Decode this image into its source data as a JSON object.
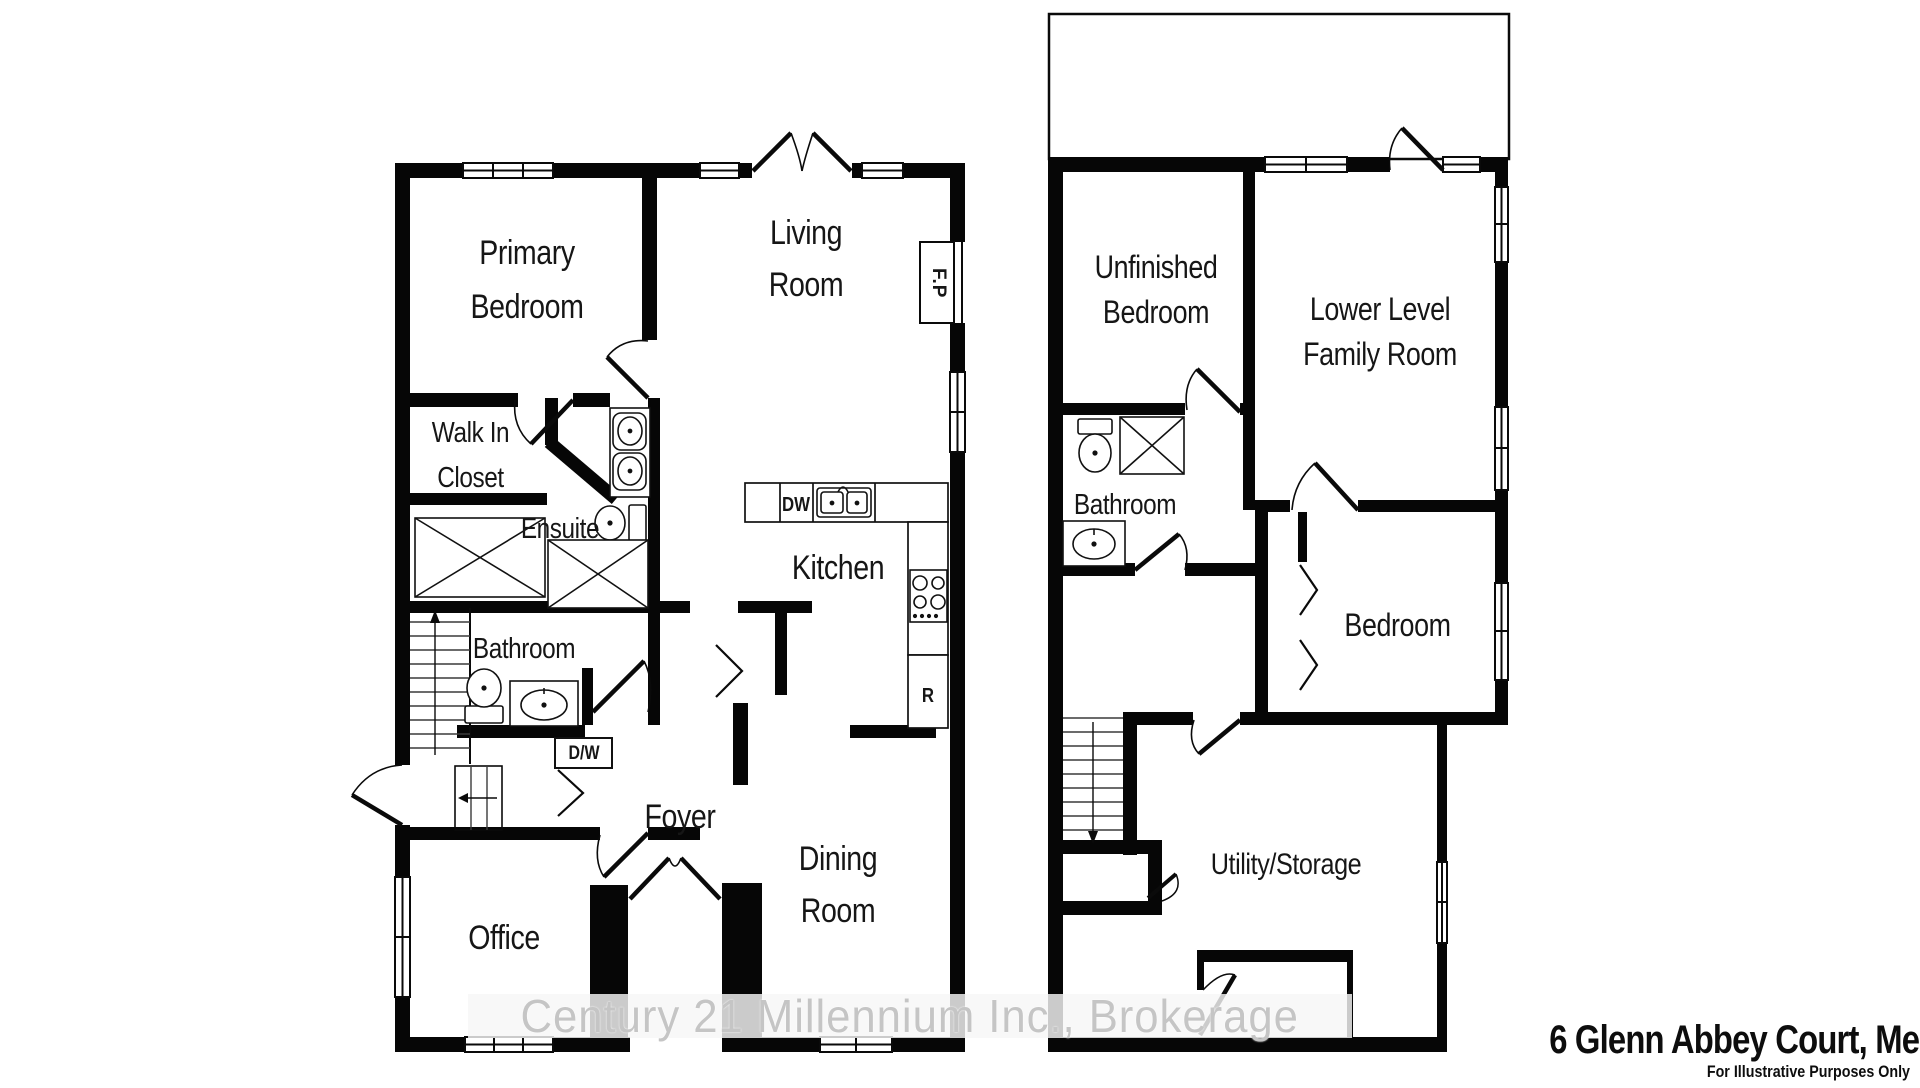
{
  "title_block": {
    "address": "6 Glenn Abbey Court, Meaford",
    "disclaimer": "For Illustrative Purposes Only"
  },
  "watermark": "Century 21 Millennium Inc., Brokerage",
  "main_floor": {
    "rooms": {
      "primary_bedroom": "Primary Bedroom",
      "walk_in_closet": "Walk In Closet",
      "ensuite": "Ensuite",
      "bathroom": "Bathroom",
      "living_room": "Living Room",
      "kitchen": "Kitchen",
      "foyer": "Foyer",
      "dining_room": "Dining Room",
      "office": "Office"
    },
    "fixtures": {
      "fireplace": "F.P",
      "dishwasher": "DW",
      "laundry_closet": "D/W",
      "refrigerator": "R"
    }
  },
  "lower_level": {
    "rooms": {
      "unfinished_bedroom": "Unfinished Bedroom",
      "family_room": "Lower Level Family Room",
      "bathroom": "Bathroom",
      "bedroom": "Bedroom",
      "utility_storage": "Utility/Storage"
    }
  }
}
